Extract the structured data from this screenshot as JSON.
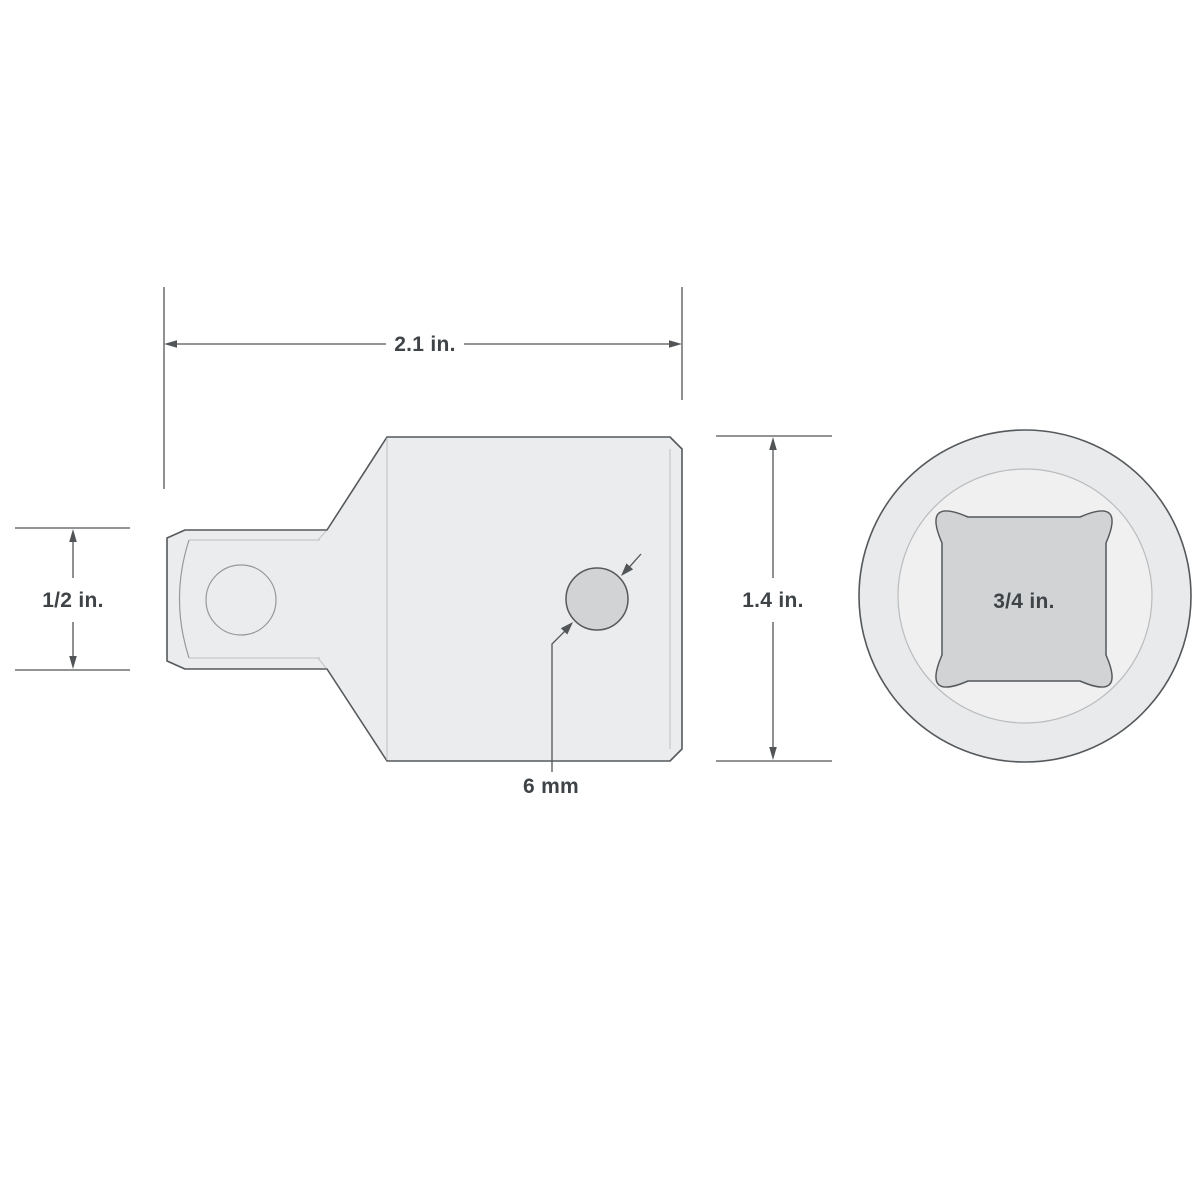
{
  "diagram": {
    "subject": "socket-adapter-dimension-drawing",
    "background": "#ffffff",
    "colors": {
      "outline": "#55595c",
      "dimension_line": "#515558",
      "detail_line": "#c5c8ca",
      "body_fill": "#ebeced",
      "recess_fill": "#d2d3d5",
      "label_text": "#3e4347"
    },
    "labels": {
      "overall_length": "2.1 in.",
      "drive_tang_size": "1/2 in.",
      "body_diameter": "1.4 in.",
      "detent_hole": "6 mm",
      "square_socket_size": "3/4 in."
    }
  }
}
